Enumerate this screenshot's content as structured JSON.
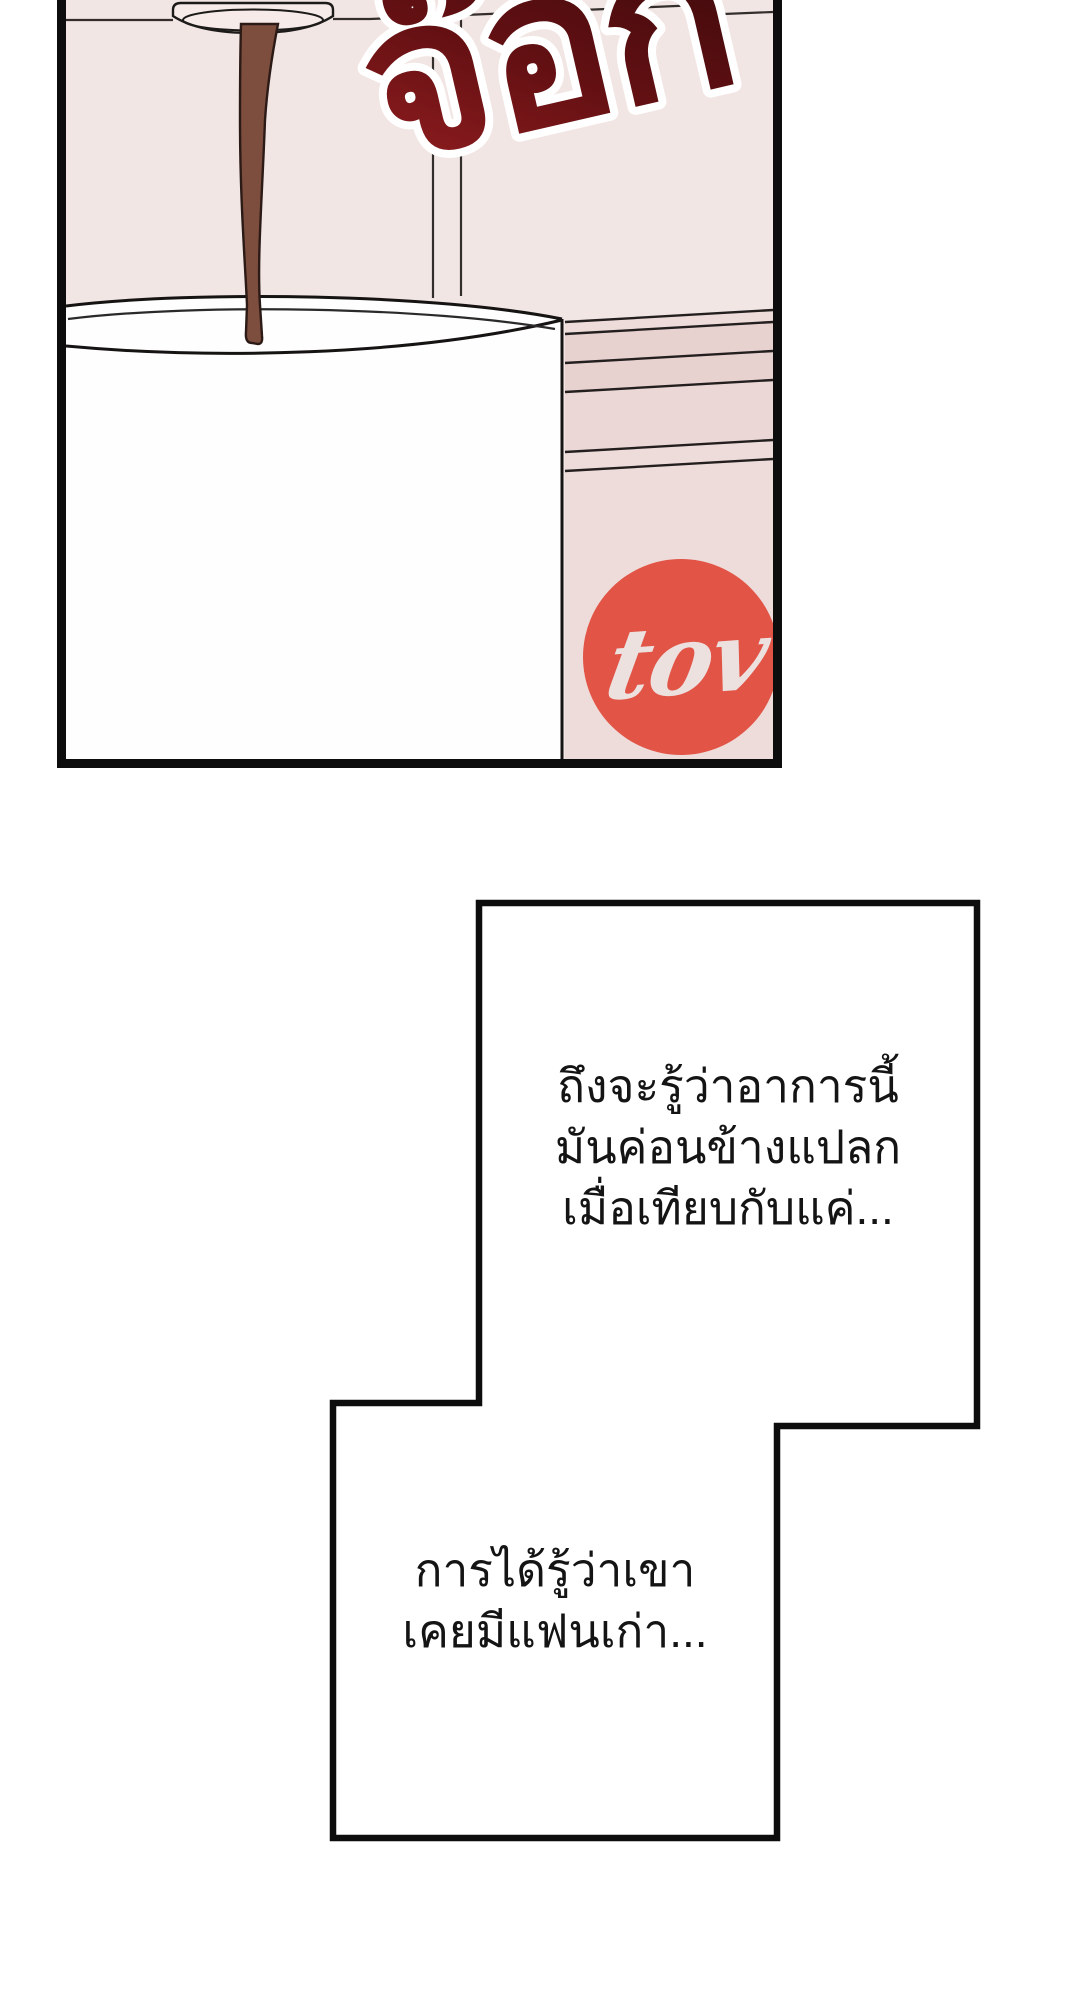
{
  "page": {
    "background_color": "#ffffff"
  },
  "panel": {
    "background_color": "#f2e6e4",
    "border_color": "#0d0d0d",
    "sound_effect": {
      "text": "จ๊อก",
      "outline_color": "#ffffff",
      "gradient_stops": [
        "#9b2022",
        "#641013",
        "#330809"
      ]
    },
    "coffee_stream_color": "#7d4e3e",
    "coffee_stream_outline": "#2b1a15",
    "cup_color": "#fffefe",
    "machine_color": "#f6ebe8",
    "package": {
      "base_color": "#eedcda",
      "band_dark_color": "#e8d2d0",
      "band_mid_color": "#ebd7d5",
      "line_color": "#241f1f",
      "logo_circle_color": "#e15446",
      "logo_text": "tov",
      "logo_text_color": "#ece1df"
    }
  },
  "speech_boxes": [
    {
      "lines": [
        "ถึงจะรู้ว่าอาการนี้",
        "มันค่อนข้างแปลก",
        "เมื่อเทียบกับแค่..."
      ]
    },
    {
      "lines": [
        "การได้รู้ว่าเขา",
        "เคยมีแฟนเก่า..."
      ]
    }
  ]
}
